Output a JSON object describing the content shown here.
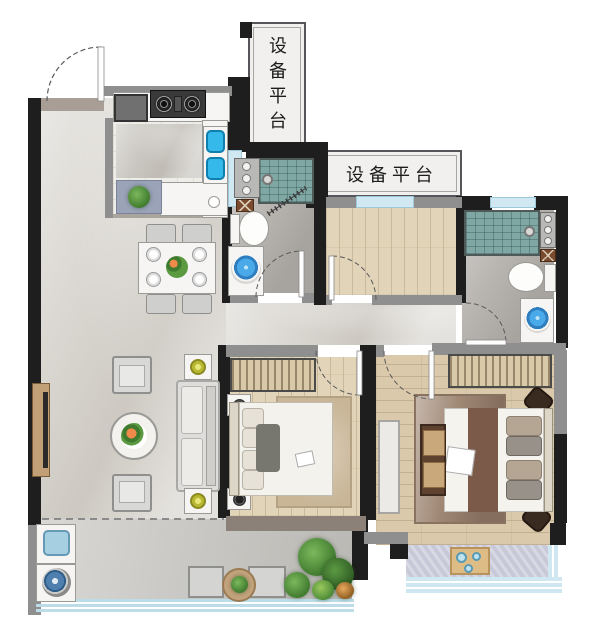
{
  "page": {
    "type": "residential floor plan",
    "background": "#ffffff"
  },
  "labels": {
    "equipment_platform_vertical": "设备平台",
    "equipment_platform_horizontal": "设备平台"
  },
  "palette": {
    "wall_black": "#1e1e1e",
    "wall_gray": "#8f8f8f",
    "window_glass": "#cfe8f2",
    "marble_floor": "#d9d6d0",
    "wood_floor": "#e1d4b8",
    "wood_floor_dark": "#dbc9ab",
    "bath_floor": "#b8b5b1",
    "shower_tile": "#7fa7a3",
    "basin_blue": "#45aede",
    "kitchen_sink_blue": "#35b8ea",
    "lamp_olive": "#b9b832",
    "plant_green": "#4c8a38",
    "rug_tan": "#c9b697",
    "rug_brown": "#a08875",
    "bed_runner_brown": "#7b5a49",
    "balcony_floor": "#c8c7c3",
    "bay_floor": "#c7c9d8",
    "railing_glass": "#bcdde8"
  },
  "rooms": {
    "entry": {
      "fixtures": [
        "entry-door"
      ]
    },
    "kitchen": {
      "fixtures": [
        "fridge",
        "gas-stove",
        "double-sink",
        "counter",
        "potted-plant"
      ]
    },
    "equipment_platform_top": {
      "label_key": "equipment_platform_vertical"
    },
    "equipment_platform_right": {
      "label_key": "equipment_platform_horizontal"
    },
    "bathroom": {
      "fixtures": [
        "shower",
        "niche-shelf",
        "floor-drain",
        "toilet",
        "round-basin",
        "swing-door"
      ]
    },
    "master_bathroom": {
      "fixtures": [
        "shower",
        "niche-shelf",
        "floor-drain",
        "toilet",
        "round-basin",
        "swing-door"
      ]
    },
    "study": {
      "fixtures": [
        "swing-door",
        "window"
      ]
    },
    "living_dining": {
      "fixtures": [
        "dining-table",
        "dining-chairs-x4",
        "plates-x4",
        "sofa",
        "coffee-table",
        "armchairs-x2",
        "floor-lamps-x2",
        "tv-wall"
      ]
    },
    "bedroom": {
      "fixtures": [
        "wardrobe",
        "double-bed",
        "nightstands-x2",
        "rug",
        "dresser",
        "swing-door"
      ]
    },
    "master_bedroom": {
      "fixtures": [
        "wardrobe",
        "double-bed",
        "bed-bench",
        "nightstands-x2",
        "rug",
        "bay-window-seat",
        "tea-tray",
        "swing-door"
      ]
    },
    "balcony": {
      "fixtures": [
        "laundry-sink",
        "washing-machine",
        "stools-x2",
        "tea-table",
        "plants",
        "glass-railing"
      ]
    }
  }
}
